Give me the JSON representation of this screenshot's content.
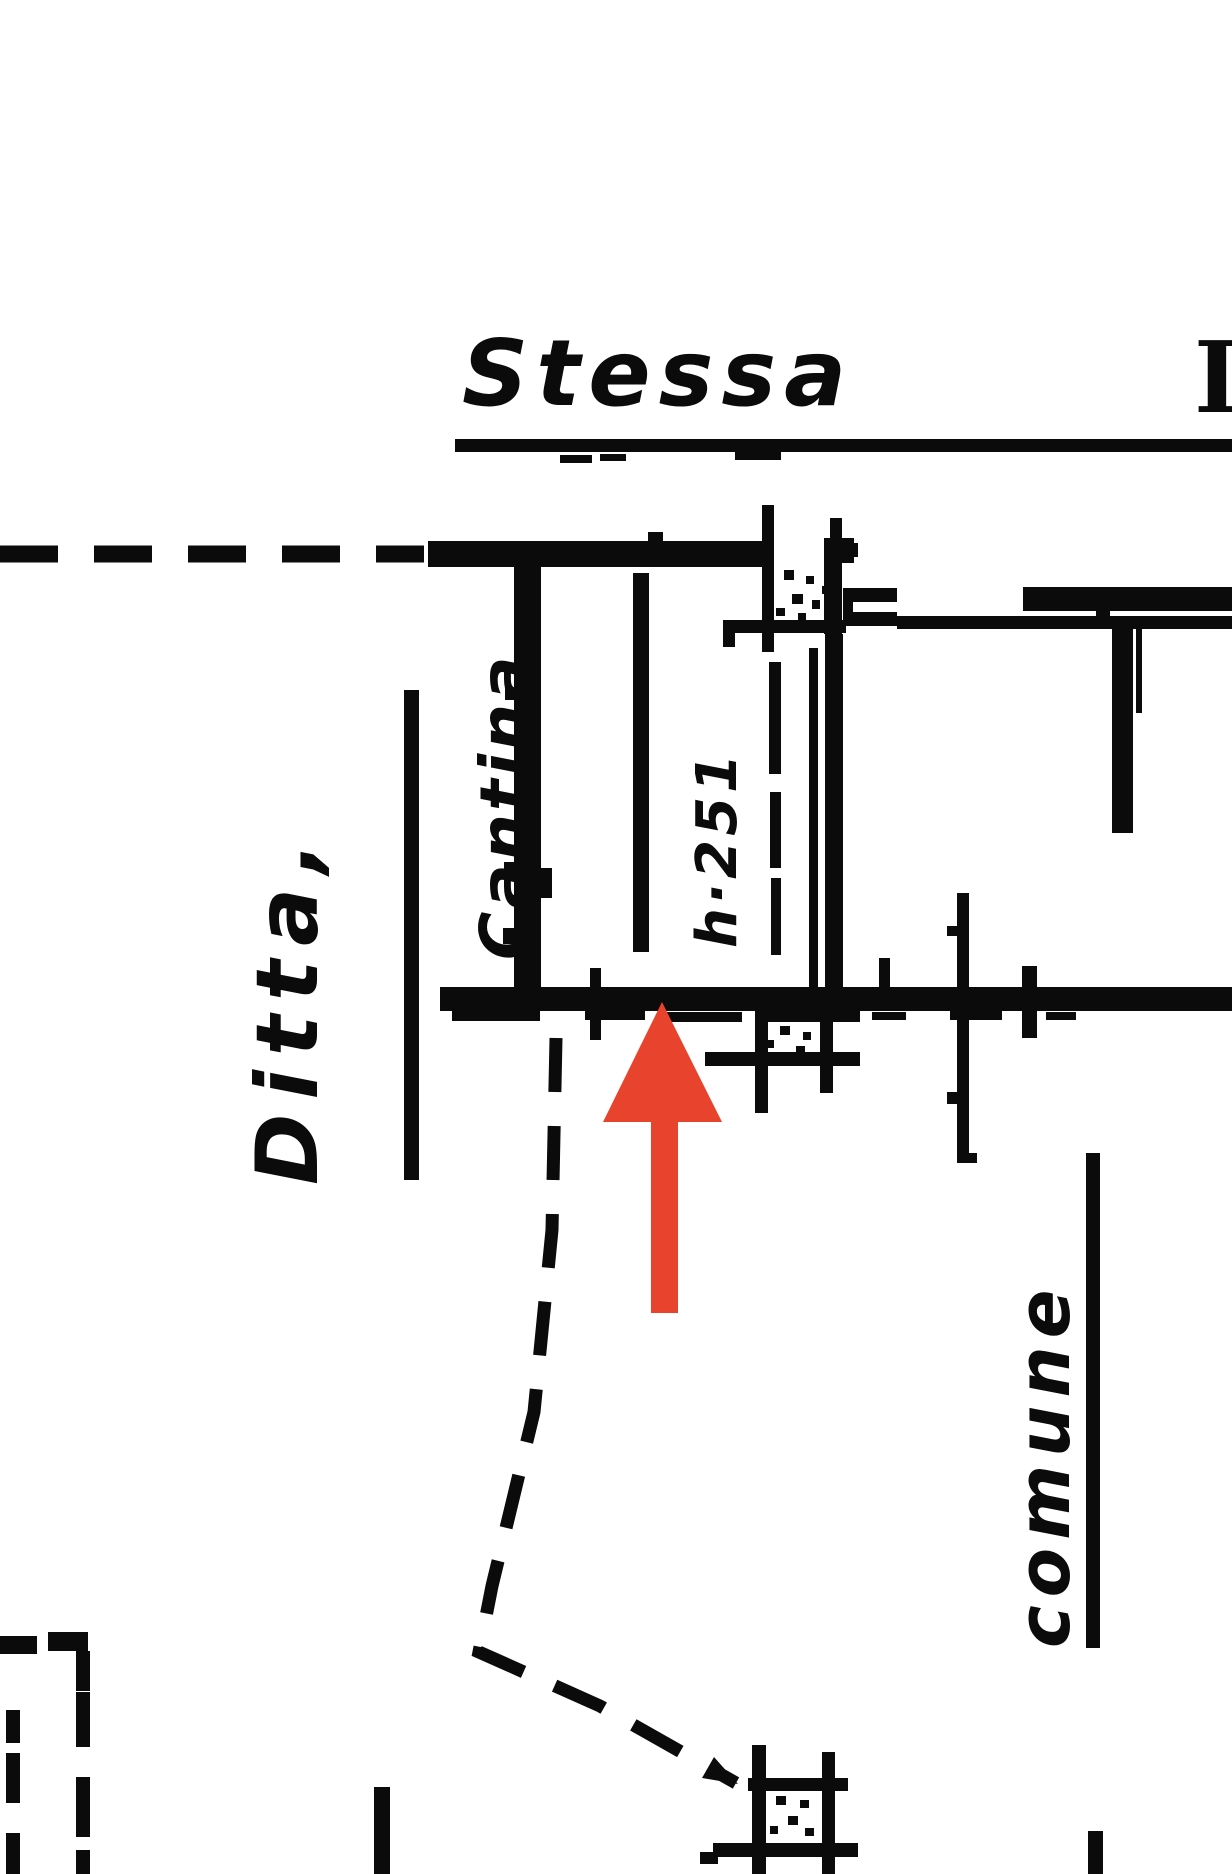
{
  "page": {
    "background_color": "#ffffff",
    "ink_color": "#0b0b0b",
    "description_texts_visible_only": true
  },
  "labels": {
    "street_title": "Stessa",
    "street_title_partial": "I",
    "owner": "Ditta,",
    "room": "Cantina",
    "height_note": "h·251",
    "boundary_note": "comune",
    "partial_word_bottom_left": "a",
    "partial_word_bottom_right": "e"
  },
  "marker": {
    "arrow_color": "#e8432c",
    "arrow_direction": "up"
  }
}
